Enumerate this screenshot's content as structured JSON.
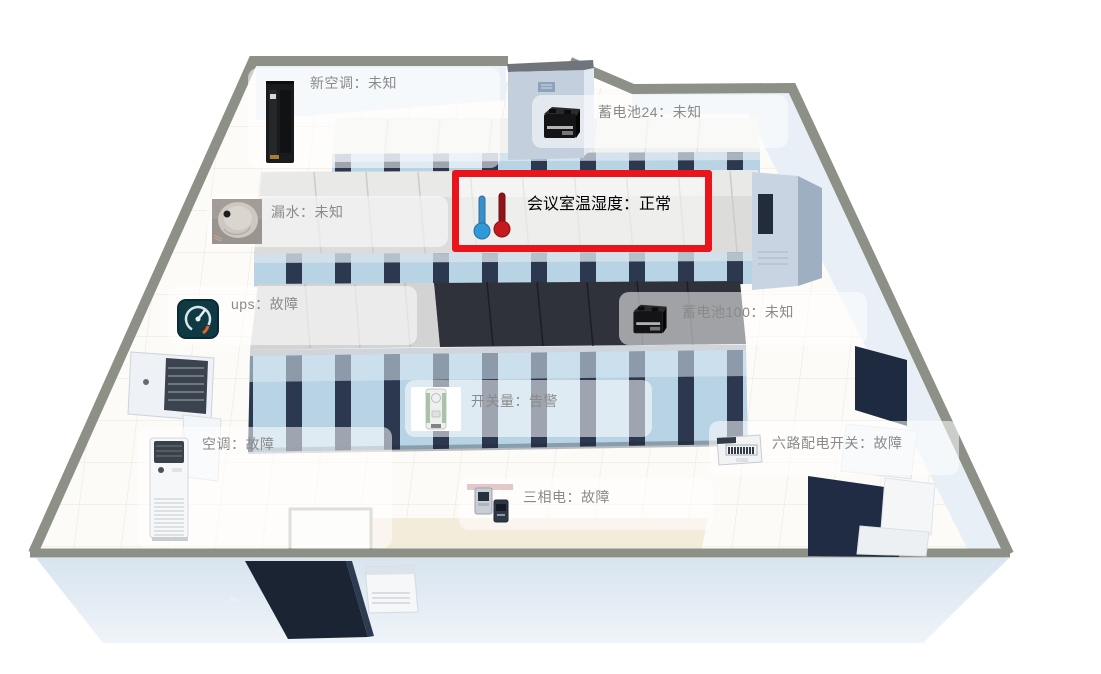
{
  "view": {
    "type": "machine-room-3d-monitor",
    "background": "#ffffff",
    "highlight_color": "#e9151b",
    "label_text_color": "#8a8a8a",
    "label_panel_bg": "rgba(255,255,255,0.55)"
  },
  "devices": [
    {
      "id": "new-ac",
      "label": "新空调",
      "status": "未知",
      "text": "新空调：未知",
      "icon": "server-cabinet-icon",
      "highlighted": false
    },
    {
      "id": "battery-24",
      "label": "蓄电池24",
      "status": "未知",
      "text": "蓄电池24：未知",
      "icon": "battery-icon",
      "highlighted": false
    },
    {
      "id": "meeting-room-th",
      "label": "会议室温湿度",
      "status": "正常",
      "text": "会议室温湿度：正常",
      "icon": "thermometer-icon",
      "highlighted": true
    },
    {
      "id": "water-leak",
      "label": "漏水",
      "status": "未知",
      "text": "漏水：未知",
      "icon": "leak-sensor-icon",
      "highlighted": false
    },
    {
      "id": "ups",
      "label": "ups",
      "status": "故障",
      "text": "ups：故障",
      "icon": "gauge-icon",
      "highlighted": false
    },
    {
      "id": "battery-100",
      "label": "蓄电池100",
      "status": "未知",
      "text": "蓄电池100：未知",
      "icon": "battery-icon",
      "highlighted": false
    },
    {
      "id": "switch-signal",
      "label": "开关量",
      "status": "告警",
      "text": "开关量：告警",
      "icon": "switch-device-icon",
      "highlighted": false
    },
    {
      "id": "air-conditioner",
      "label": "空调",
      "status": "故障",
      "text": "空调：故障",
      "icon": "floor-ac-icon",
      "highlighted": false
    },
    {
      "id": "six-way-switch",
      "label": "六路配电开关",
      "status": "故障",
      "text": "六路配电开关：故障",
      "icon": "distribution-box-icon",
      "highlighted": false
    },
    {
      "id": "three-phase",
      "label": "三相电",
      "status": "故障",
      "text": "三相电：故障",
      "icon": "power-meter-icon",
      "highlighted": false
    }
  ]
}
